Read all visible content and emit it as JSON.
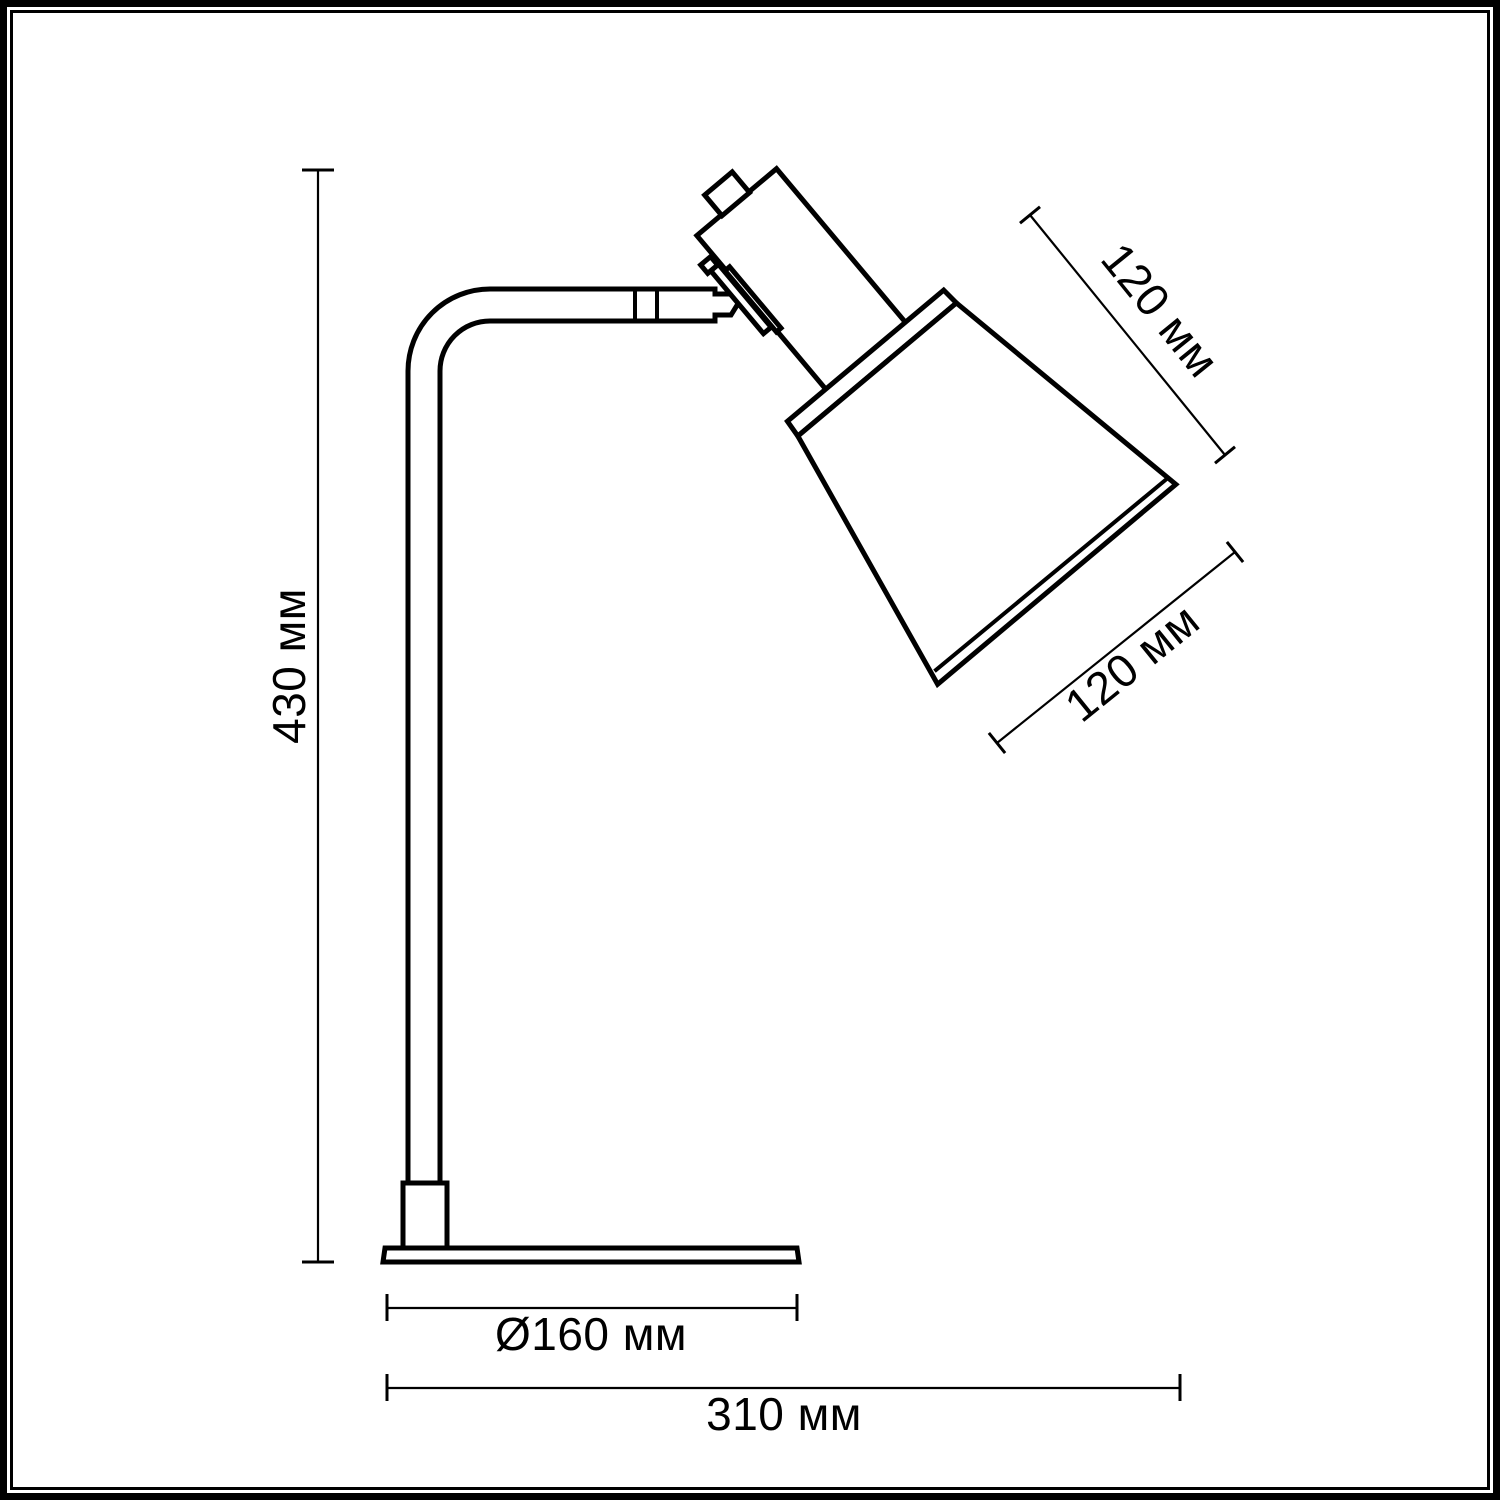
{
  "page": {
    "background": "#ffffff",
    "stroke_color": "#000000",
    "text_color": "#000000"
  },
  "dimensions": {
    "height": {
      "value": 430,
      "unit": "мм",
      "label": "430 мм"
    },
    "shade_top": {
      "value": 120,
      "unit": "мм",
      "label": "120 мм"
    },
    "shade_bottom": {
      "value": 120,
      "unit": "мм",
      "label": "120 мм"
    },
    "base_diameter": {
      "value": 160,
      "unit": "мм",
      "label": "Ø160 мм"
    },
    "overall_width": {
      "value": 310,
      "unit": "мм",
      "label": "310 мм"
    }
  }
}
